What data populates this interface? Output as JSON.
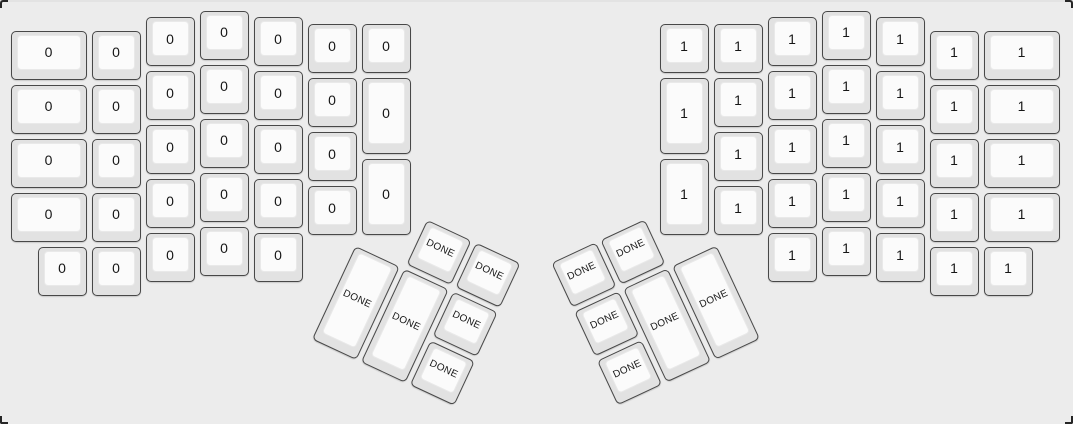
{
  "app": {
    "description": "ErgoDox split keyboard layout render (keyboard layout editor view)",
    "background_color": "#ececec",
    "corner_mark_color": "#262626"
  },
  "keyboard": {
    "unit_px": 54,
    "key_margin_px": 2.5,
    "colors": {
      "cap": "#e2e2e2",
      "cap_border": "#484848",
      "top": "#fbfbfb",
      "top_border": "#e9e9e9",
      "label": "#161616"
    },
    "legend_summary": {
      "left_half_label": "0",
      "right_half_label": "1",
      "thumb_label": "DONE"
    },
    "groups": [
      {
        "name": "left-main",
        "origin_px": {
          "x": 8,
          "y": 8
        },
        "rotation_deg": 0,
        "keys": [
          {
            "x": 0,
            "y": 0.375,
            "w": 1.5,
            "h": 1,
            "label": "0"
          },
          {
            "x": 0,
            "y": 1.375,
            "w": 1.5,
            "h": 1,
            "label": "0"
          },
          {
            "x": 0,
            "y": 2.375,
            "w": 1.5,
            "h": 1,
            "label": "0"
          },
          {
            "x": 0,
            "y": 3.375,
            "w": 1.5,
            "h": 1,
            "label": "0"
          },
          {
            "x": 1.5,
            "y": 0.375,
            "w": 1,
            "h": 1,
            "label": "0"
          },
          {
            "x": 1.5,
            "y": 1.375,
            "w": 1,
            "h": 1,
            "label": "0"
          },
          {
            "x": 1.5,
            "y": 2.375,
            "w": 1,
            "h": 1,
            "label": "0"
          },
          {
            "x": 1.5,
            "y": 3.375,
            "w": 1,
            "h": 1,
            "label": "0"
          },
          {
            "x": 2.5,
            "y": 0.125,
            "w": 1,
            "h": 1,
            "label": "0"
          },
          {
            "x": 2.5,
            "y": 1.125,
            "w": 1,
            "h": 1,
            "label": "0"
          },
          {
            "x": 2.5,
            "y": 2.125,
            "w": 1,
            "h": 1,
            "label": "0"
          },
          {
            "x": 2.5,
            "y": 3.125,
            "w": 1,
            "h": 1,
            "label": "0"
          },
          {
            "x": 3.5,
            "y": 0,
            "w": 1,
            "h": 1,
            "label": "0"
          },
          {
            "x": 3.5,
            "y": 1,
            "w": 1,
            "h": 1,
            "label": "0"
          },
          {
            "x": 3.5,
            "y": 2,
            "w": 1,
            "h": 1,
            "label": "0"
          },
          {
            "x": 3.5,
            "y": 3,
            "w": 1,
            "h": 1,
            "label": "0"
          },
          {
            "x": 4.5,
            "y": 0.125,
            "w": 1,
            "h": 1,
            "label": "0"
          },
          {
            "x": 4.5,
            "y": 1.125,
            "w": 1,
            "h": 1,
            "label": "0"
          },
          {
            "x": 4.5,
            "y": 2.125,
            "w": 1,
            "h": 1,
            "label": "0"
          },
          {
            "x": 4.5,
            "y": 3.125,
            "w": 1,
            "h": 1,
            "label": "0"
          },
          {
            "x": 5.5,
            "y": 0.25,
            "w": 1,
            "h": 1,
            "label": "0"
          },
          {
            "x": 5.5,
            "y": 1.25,
            "w": 1,
            "h": 1,
            "label": "0"
          },
          {
            "x": 5.5,
            "y": 2.25,
            "w": 1,
            "h": 1,
            "label": "0"
          },
          {
            "x": 5.5,
            "y": 3.25,
            "w": 1,
            "h": 1,
            "label": "0"
          },
          {
            "x": 6.5,
            "y": 0.25,
            "w": 1,
            "h": 1,
            "label": "0"
          },
          {
            "x": 6.5,
            "y": 1.25,
            "w": 1,
            "h": 1.5,
            "label": "0"
          },
          {
            "x": 6.5,
            "y": 2.75,
            "w": 1,
            "h": 1.5,
            "label": "0"
          },
          {
            "x": 0.5,
            "y": 4.375,
            "w": 1,
            "h": 1,
            "label": "0"
          },
          {
            "x": 1.5,
            "y": 4.375,
            "w": 1,
            "h": 1,
            "label": "0"
          },
          {
            "x": 2.5,
            "y": 4.125,
            "w": 1,
            "h": 1,
            "label": "0"
          },
          {
            "x": 3.5,
            "y": 4,
            "w": 1,
            "h": 1,
            "label": "0"
          },
          {
            "x": 4.5,
            "y": 4.125,
            "w": 1,
            "h": 1,
            "label": "0"
          }
        ]
      },
      {
        "name": "right-main",
        "origin_px": {
          "x": 657,
          "y": 8
        },
        "rotation_deg": 0,
        "keys": [
          {
            "x": 0,
            "y": 0.25,
            "w": 1,
            "h": 1,
            "label": "1"
          },
          {
            "x": 0,
            "y": 1.25,
            "w": 1,
            "h": 1.5,
            "label": "1"
          },
          {
            "x": 0,
            "y": 2.75,
            "w": 1,
            "h": 1.5,
            "label": "1"
          },
          {
            "x": 1,
            "y": 0.25,
            "w": 1,
            "h": 1,
            "label": "1"
          },
          {
            "x": 1,
            "y": 1.25,
            "w": 1,
            "h": 1,
            "label": "1"
          },
          {
            "x": 1,
            "y": 2.25,
            "w": 1,
            "h": 1,
            "label": "1"
          },
          {
            "x": 1,
            "y": 3.25,
            "w": 1,
            "h": 1,
            "label": "1"
          },
          {
            "x": 2,
            "y": 0.125,
            "w": 1,
            "h": 1,
            "label": "1"
          },
          {
            "x": 2,
            "y": 1.125,
            "w": 1,
            "h": 1,
            "label": "1"
          },
          {
            "x": 2,
            "y": 2.125,
            "w": 1,
            "h": 1,
            "label": "1"
          },
          {
            "x": 2,
            "y": 3.125,
            "w": 1,
            "h": 1,
            "label": "1"
          },
          {
            "x": 3,
            "y": 0,
            "w": 1,
            "h": 1,
            "label": "1"
          },
          {
            "x": 3,
            "y": 1,
            "w": 1,
            "h": 1,
            "label": "1"
          },
          {
            "x": 3,
            "y": 2,
            "w": 1,
            "h": 1,
            "label": "1"
          },
          {
            "x": 3,
            "y": 3,
            "w": 1,
            "h": 1,
            "label": "1"
          },
          {
            "x": 4,
            "y": 0.125,
            "w": 1,
            "h": 1,
            "label": "1"
          },
          {
            "x": 4,
            "y": 1.125,
            "w": 1,
            "h": 1,
            "label": "1"
          },
          {
            "x": 4,
            "y": 2.125,
            "w": 1,
            "h": 1,
            "label": "1"
          },
          {
            "x": 4,
            "y": 3.125,
            "w": 1,
            "h": 1,
            "label": "1"
          },
          {
            "x": 5,
            "y": 0.375,
            "w": 1,
            "h": 1,
            "label": "1"
          },
          {
            "x": 5,
            "y": 1.375,
            "w": 1,
            "h": 1,
            "label": "1"
          },
          {
            "x": 5,
            "y": 2.375,
            "w": 1,
            "h": 1,
            "label": "1"
          },
          {
            "x": 5,
            "y": 3.375,
            "w": 1,
            "h": 1,
            "label": "1"
          },
          {
            "x": 6,
            "y": 0.375,
            "w": 1.5,
            "h": 1,
            "label": "1"
          },
          {
            "x": 6,
            "y": 1.375,
            "w": 1.5,
            "h": 1,
            "label": "1"
          },
          {
            "x": 6,
            "y": 2.375,
            "w": 1.5,
            "h": 1,
            "label": "1"
          },
          {
            "x": 6,
            "y": 3.375,
            "w": 1.5,
            "h": 1,
            "label": "1"
          },
          {
            "x": 2,
            "y": 4.125,
            "w": 1,
            "h": 1,
            "label": "1"
          },
          {
            "x": 3,
            "y": 4,
            "w": 1,
            "h": 1,
            "label": "1"
          },
          {
            "x": 4,
            "y": 4.125,
            "w": 1,
            "h": 1,
            "label": "1"
          },
          {
            "x": 5,
            "y": 4.375,
            "w": 1,
            "h": 1,
            "label": "1"
          },
          {
            "x": 6,
            "y": 4.375,
            "w": 1,
            "h": 1,
            "label": "1"
          }
        ]
      },
      {
        "name": "left-thumb",
        "origin_px": {
          "x": 354,
          "y": 242
        },
        "rotation_deg": 25,
        "keys": [
          {
            "x": 1,
            "y": -1,
            "w": 1,
            "h": 1,
            "label": "DONE"
          },
          {
            "x": 2,
            "y": -1,
            "w": 1,
            "h": 1,
            "label": "DONE"
          },
          {
            "x": 0,
            "y": 0,
            "w": 1,
            "h": 2,
            "label": "DONE"
          },
          {
            "x": 1,
            "y": 0,
            "w": 1,
            "h": 2,
            "label": "DONE"
          },
          {
            "x": 2,
            "y": 0,
            "w": 1,
            "h": 1,
            "label": "DONE"
          },
          {
            "x": 2,
            "y": 1,
            "w": 1,
            "h": 1,
            "label": "DONE"
          }
        ]
      },
      {
        "name": "right-thumb",
        "origin_px": {
          "x": 717,
          "y": 242
        },
        "rotation_deg": -25,
        "keys": [
          {
            "x": -2,
            "y": -1,
            "w": 1,
            "h": 1,
            "label": "DONE"
          },
          {
            "x": -3,
            "y": -1,
            "w": 1,
            "h": 1,
            "label": "DONE"
          },
          {
            "x": -1,
            "y": 0,
            "w": 1,
            "h": 2,
            "label": "DONE"
          },
          {
            "x": -2,
            "y": 0,
            "w": 1,
            "h": 2,
            "label": "DONE"
          },
          {
            "x": -3,
            "y": 0,
            "w": 1,
            "h": 1,
            "label": "DONE"
          },
          {
            "x": -3,
            "y": 1,
            "w": 1,
            "h": 1,
            "label": "DONE"
          }
        ]
      }
    ]
  }
}
